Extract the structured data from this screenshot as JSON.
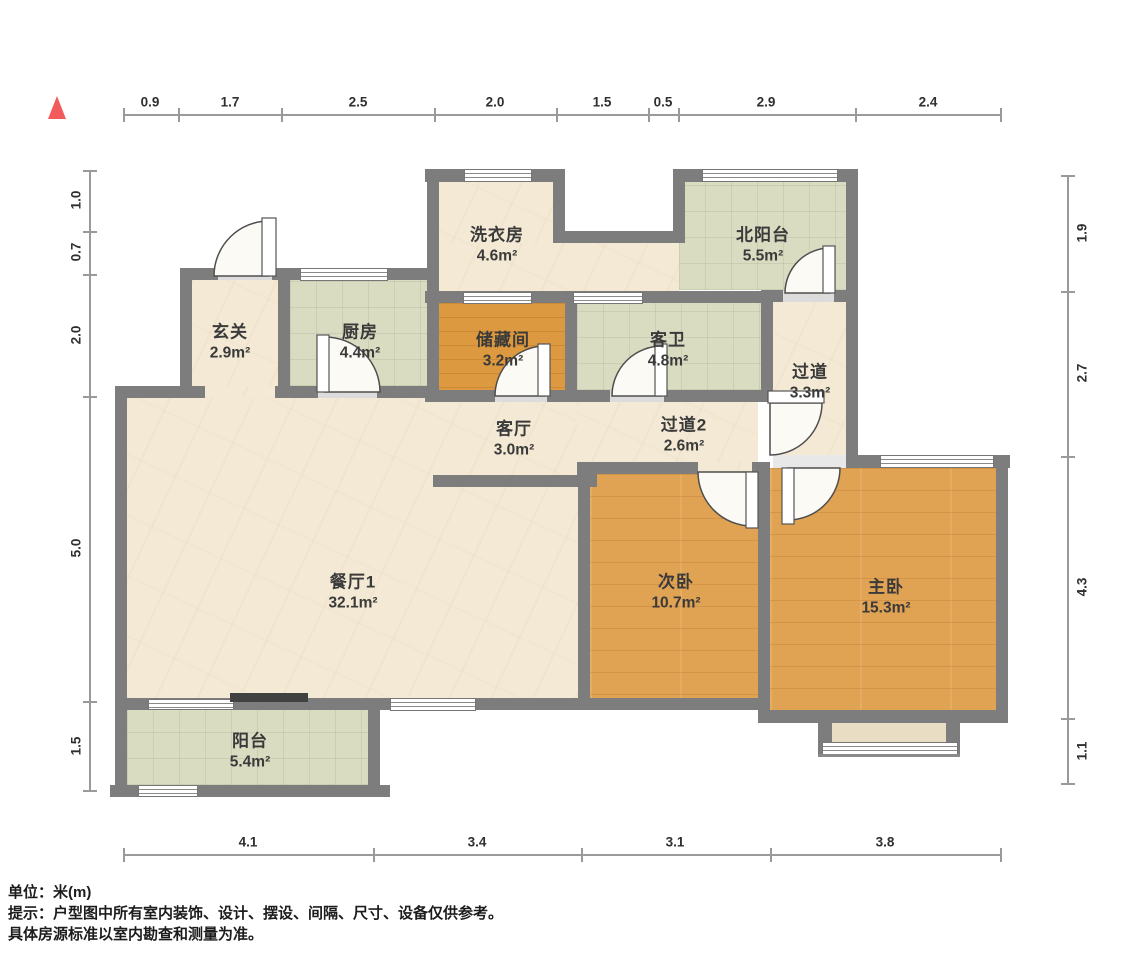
{
  "compass": {
    "icon": "north-triangle-icon",
    "color": "#f15b5b"
  },
  "dimensions": {
    "top": [
      "0.9",
      "1.7",
      "2.5",
      "2.0",
      "1.5",
      "0.5",
      "2.9",
      "2.4"
    ],
    "left": [
      "1.0",
      "0.7",
      "2.0",
      "5.0",
      "1.5"
    ],
    "right": [
      "1.9",
      "2.7",
      "4.3",
      "1.1"
    ],
    "bottom": [
      "4.1",
      "3.4",
      "3.1",
      "3.8"
    ]
  },
  "rooms": [
    {
      "name": "洗衣房",
      "area": "4.6m²"
    },
    {
      "name": "北阳台",
      "area": "5.5m²"
    },
    {
      "name": "玄关",
      "area": "2.9m²"
    },
    {
      "name": "厨房",
      "area": "4.4m²"
    },
    {
      "name": "储藏间",
      "area": "3.2m²"
    },
    {
      "name": "客卫",
      "area": "4.8m²"
    },
    {
      "name": "过道",
      "area": "3.3m²"
    },
    {
      "name": "客厅",
      "area": "3.0m²"
    },
    {
      "name": "过道2",
      "area": "2.6m²"
    },
    {
      "name": "餐厅1",
      "area": "32.1m²"
    },
    {
      "name": "次卧",
      "area": "10.7m²"
    },
    {
      "name": "主卧",
      "area": "15.3m²"
    },
    {
      "name": "阳台",
      "area": "5.4m²"
    }
  ],
  "footer": {
    "unit": "单位：米(m)",
    "tip_line1": "提示：户型图中所有室内装饰、设计、摆设、间隔、尺寸、设备仅供参考。",
    "tip_line2": "具体房源标准以室内勘查和测量为准。"
  },
  "colors": {
    "wall": "#7d7d7d",
    "floor_marble": "#f3e9d5",
    "floor_tile": "#dadcc2",
    "floor_wood": "#e0a253",
    "north_indicator": "#f15b5b"
  }
}
